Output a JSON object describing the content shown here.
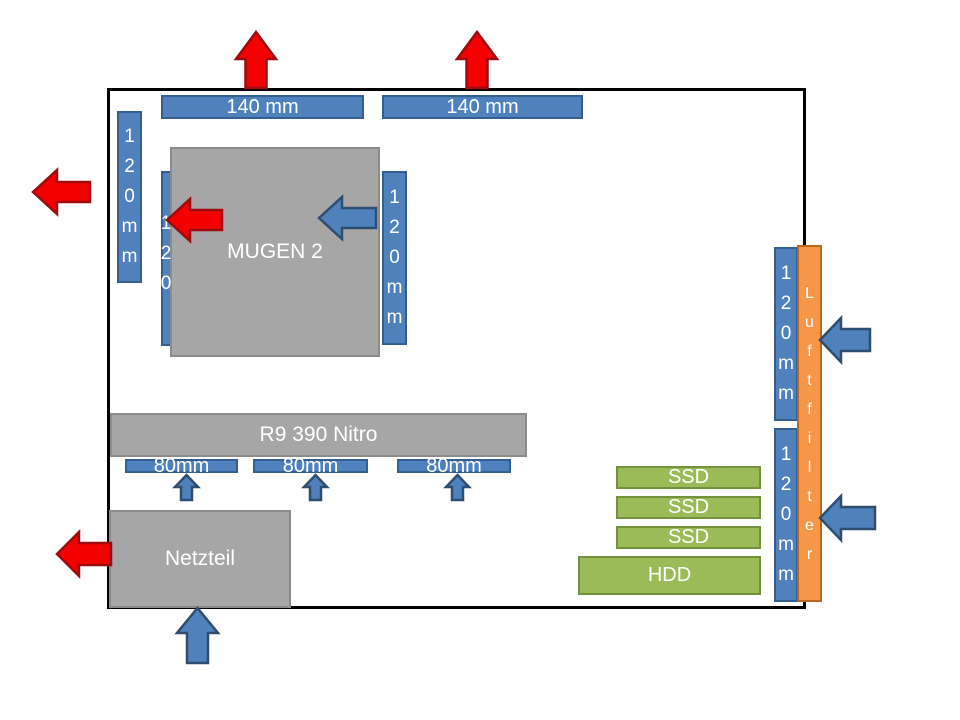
{
  "colors": {
    "fan_blue": "#4f81bd",
    "fan_blue_border": "#365f91",
    "component_gray": "#a6a6a6",
    "component_gray_border": "#8b8b8b",
    "drive_green": "#9bbb59",
    "drive_green_border": "#74923e",
    "filter_orange": "#f79646",
    "filter_orange_border": "#bc671f",
    "exhaust_arrow_red": "#f40000",
    "intake_arrow_blue": "#4f81bd",
    "case_border": "#000000",
    "label_text": "#ffffff"
  },
  "case": {
    "top_fans": [
      {
        "label": "140 mm"
      },
      {
        "label": "140 mm"
      }
    ],
    "rear_fan": {
      "label": "120mm"
    },
    "cpu_cooler": {
      "label": "MUGEN 2",
      "front_fan_label": "120",
      "rear_fan_label": "120mm"
    },
    "gpu": {
      "label": "R9 390 Nitro",
      "fans": [
        {
          "label": "80mm"
        },
        {
          "label": "80mm"
        },
        {
          "label": "80mm"
        }
      ]
    },
    "psu": {
      "label": "Netzteil"
    },
    "drives": {
      "ssds": [
        {
          "label": "SSD"
        },
        {
          "label": "SSD"
        },
        {
          "label": "SSD"
        }
      ],
      "hdd": {
        "label": "HDD"
      }
    },
    "front_fans": [
      {
        "label": "120mm"
      },
      {
        "label": "120mm"
      }
    ],
    "air_filter": {
      "label": "Luftfilter"
    }
  }
}
